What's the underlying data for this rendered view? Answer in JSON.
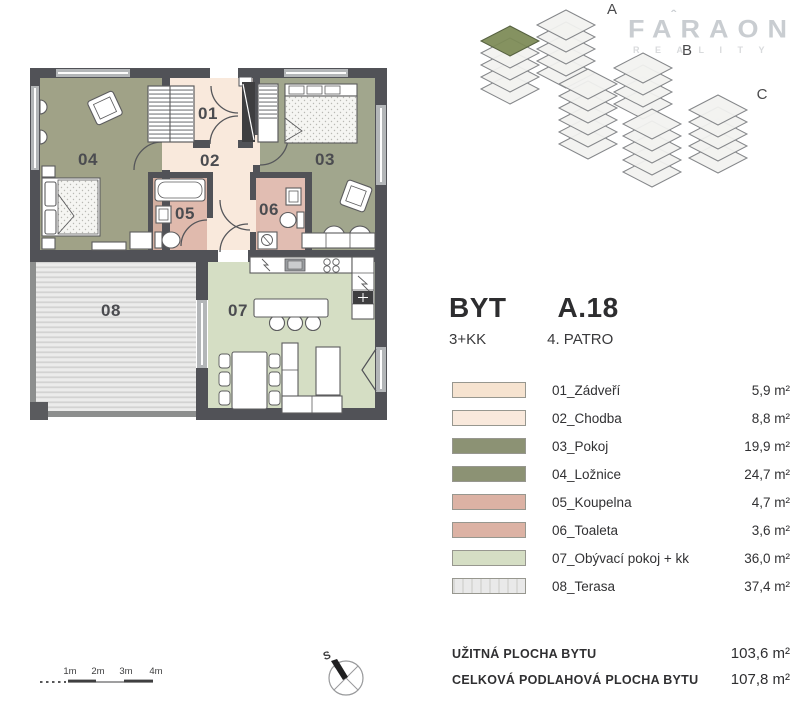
{
  "logo": {
    "brand": "FARAON",
    "tagline": "REALITY"
  },
  "building": {
    "section_labels": [
      "A",
      "B",
      "C"
    ],
    "highlight_color": "#7c8a55"
  },
  "header": {
    "product_label": "BYT",
    "unit_code": "A.18",
    "disposition": "3+KK",
    "floor": "4. PATRO"
  },
  "legend": {
    "items": [
      {
        "label": "01_Zádveří",
        "area": "5,9 m²",
        "color": "#f6e3d0"
      },
      {
        "label": "02_Chodba",
        "area": "8,8 m²",
        "color": "#f9e9dc"
      },
      {
        "label": "03_Pokoj",
        "area": "19,9 m²",
        "color": "#8c9274"
      },
      {
        "label": "04_Ložnice",
        "area": "24,7 m²",
        "color": "#8c9274"
      },
      {
        "label": "05_Koupelna",
        "area": "4,7 m²",
        "color": "#dcb2a4"
      },
      {
        "label": "06_Toaleta",
        "area": "3,6 m²",
        "color": "#dcb2a4"
      },
      {
        "label": "07_Obývací pokoj + kk",
        "area": "36,0 m²",
        "color": "#d5dec4"
      },
      {
        "label": "08_Terasa",
        "area": "37,4 m²",
        "color": "#e9e9e9"
      }
    ]
  },
  "totals": [
    {
      "label": "UŽITNÁ PLOCHA BYTU",
      "value": "103,6 m²"
    },
    {
      "label": "CELKOVÁ PODLAHOVÁ PLOCHA BYTU",
      "value": "107,8 m²"
    }
  ],
  "floorplan": {
    "room_labels": [
      "01",
      "02",
      "03",
      "04",
      "05",
      "06",
      "07",
      "08"
    ]
  },
  "scalebar": {
    "labels": [
      "1m",
      "2m",
      "3m",
      "4m"
    ]
  },
  "compass": {
    "north_label": "S"
  }
}
